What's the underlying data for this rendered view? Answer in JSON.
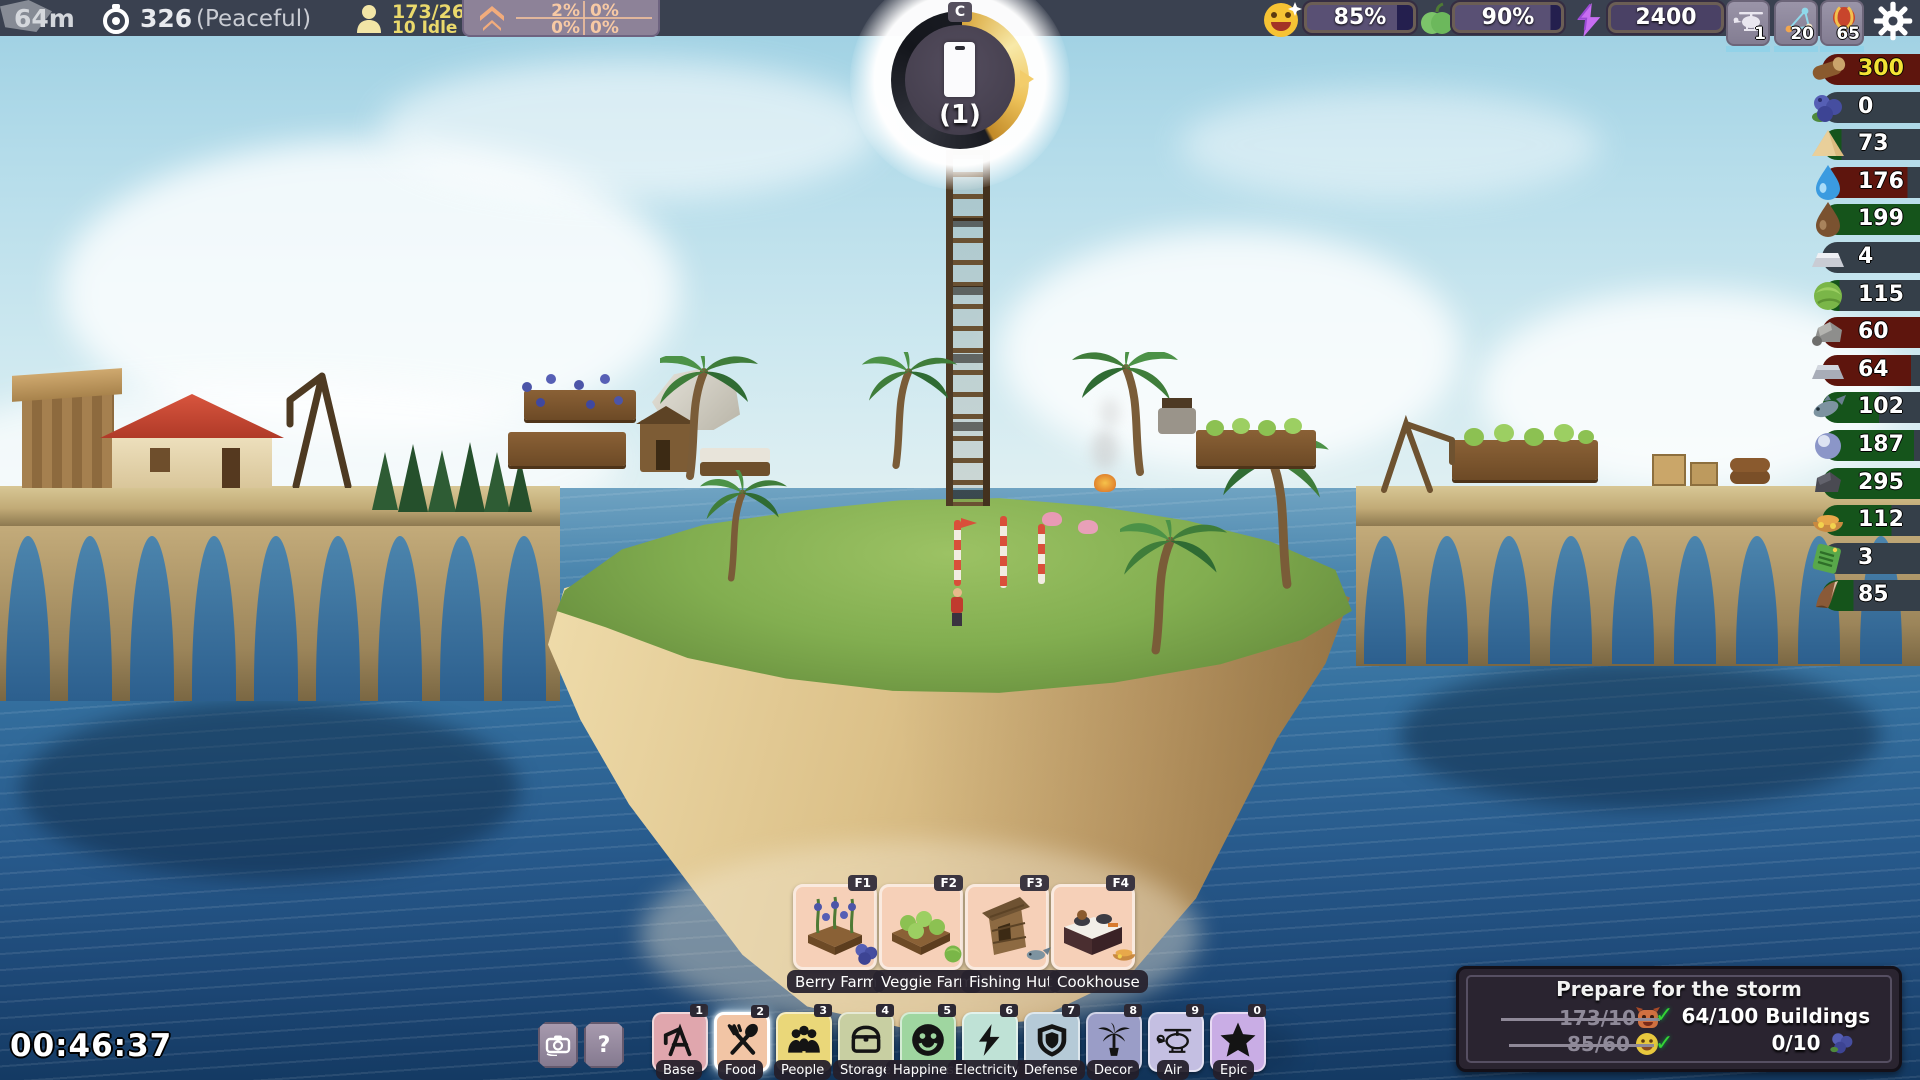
{
  "top_bar": {
    "altitude": "64m",
    "day": "326",
    "mode": "(Peaceful)",
    "population": "173/260",
    "idle": "10 Idle",
    "growth": {
      "tl": "2%",
      "tr": "0%",
      "bl": "0%",
      "br": "0%"
    }
  },
  "gauge": {
    "keybind": "C",
    "count": "(1)"
  },
  "status": {
    "happiness": "85%",
    "food": "90%",
    "power": "2400",
    "air_units": [
      {
        "name": "helicopter",
        "count": "1"
      },
      {
        "name": "drone-network",
        "count": "20"
      },
      {
        "name": "balloon",
        "count": "65"
      }
    ]
  },
  "resources": [
    {
      "icon": "wood-log",
      "value": "300"
    },
    {
      "icon": "blueberries",
      "value": "0"
    },
    {
      "icon": "sand",
      "value": "73"
    },
    {
      "icon": "water",
      "value": "176"
    },
    {
      "icon": "mud",
      "value": "199"
    },
    {
      "icon": "silver-ingot",
      "value": "4"
    },
    {
      "icon": "cabbage",
      "value": "115"
    },
    {
      "icon": "stone",
      "value": "60"
    },
    {
      "icon": "iron-ingot",
      "value": "64"
    },
    {
      "icon": "fish",
      "value": "102"
    },
    {
      "icon": "pearl",
      "value": "187"
    },
    {
      "icon": "coal",
      "value": "295"
    },
    {
      "icon": "cooked-meal",
      "value": "112"
    },
    {
      "icon": "circuit-board",
      "value": "3"
    },
    {
      "icon": "horn",
      "value": "85"
    }
  ],
  "timer": {
    "value": "00:46:37"
  },
  "helper": {
    "help": "?"
  },
  "subtoolbar": {
    "items": [
      {
        "key": "F1",
        "label": "Berry Farm"
      },
      {
        "key": "F2",
        "label": "Veggie Farm"
      },
      {
        "key": "F3",
        "label": "Fishing Hut"
      },
      {
        "key": "F4",
        "label": "Cookhouse"
      }
    ]
  },
  "toolbar": {
    "items": [
      {
        "key": "1",
        "label": "Base",
        "color": "#e0a6ad"
      },
      {
        "key": "2",
        "label": "Food",
        "color": "#f2c5a5",
        "selected": true
      },
      {
        "key": "3",
        "label": "People",
        "color": "#ead779"
      },
      {
        "key": "4",
        "label": "Storage",
        "color": "#c8cfa2"
      },
      {
        "key": "5",
        "label": "Happiness",
        "color": "#9fd6a0"
      },
      {
        "key": "6",
        "label": "Electricity",
        "color": "#bfe2d6"
      },
      {
        "key": "7",
        "label": "Defense",
        "color": "#b5cad7"
      },
      {
        "key": "8",
        "label": "Decor",
        "color": "#9a9dc7"
      },
      {
        "key": "9",
        "label": "Air",
        "color": "#c4bfe2"
      },
      {
        "key": "0",
        "label": "Epic",
        "color": "#c9ade5"
      }
    ]
  },
  "storm": {
    "title": "Prepare for the storm",
    "check": "✓",
    "done": [
      {
        "text": "173/10",
        "icon": "monster-emoji"
      },
      {
        "text": "85/60",
        "icon": "smiley-emoji"
      }
    ],
    "todo": [
      {
        "text": "64/100 Buildings"
      },
      {
        "text": "0/10",
        "icon": "blueberries"
      }
    ]
  }
}
